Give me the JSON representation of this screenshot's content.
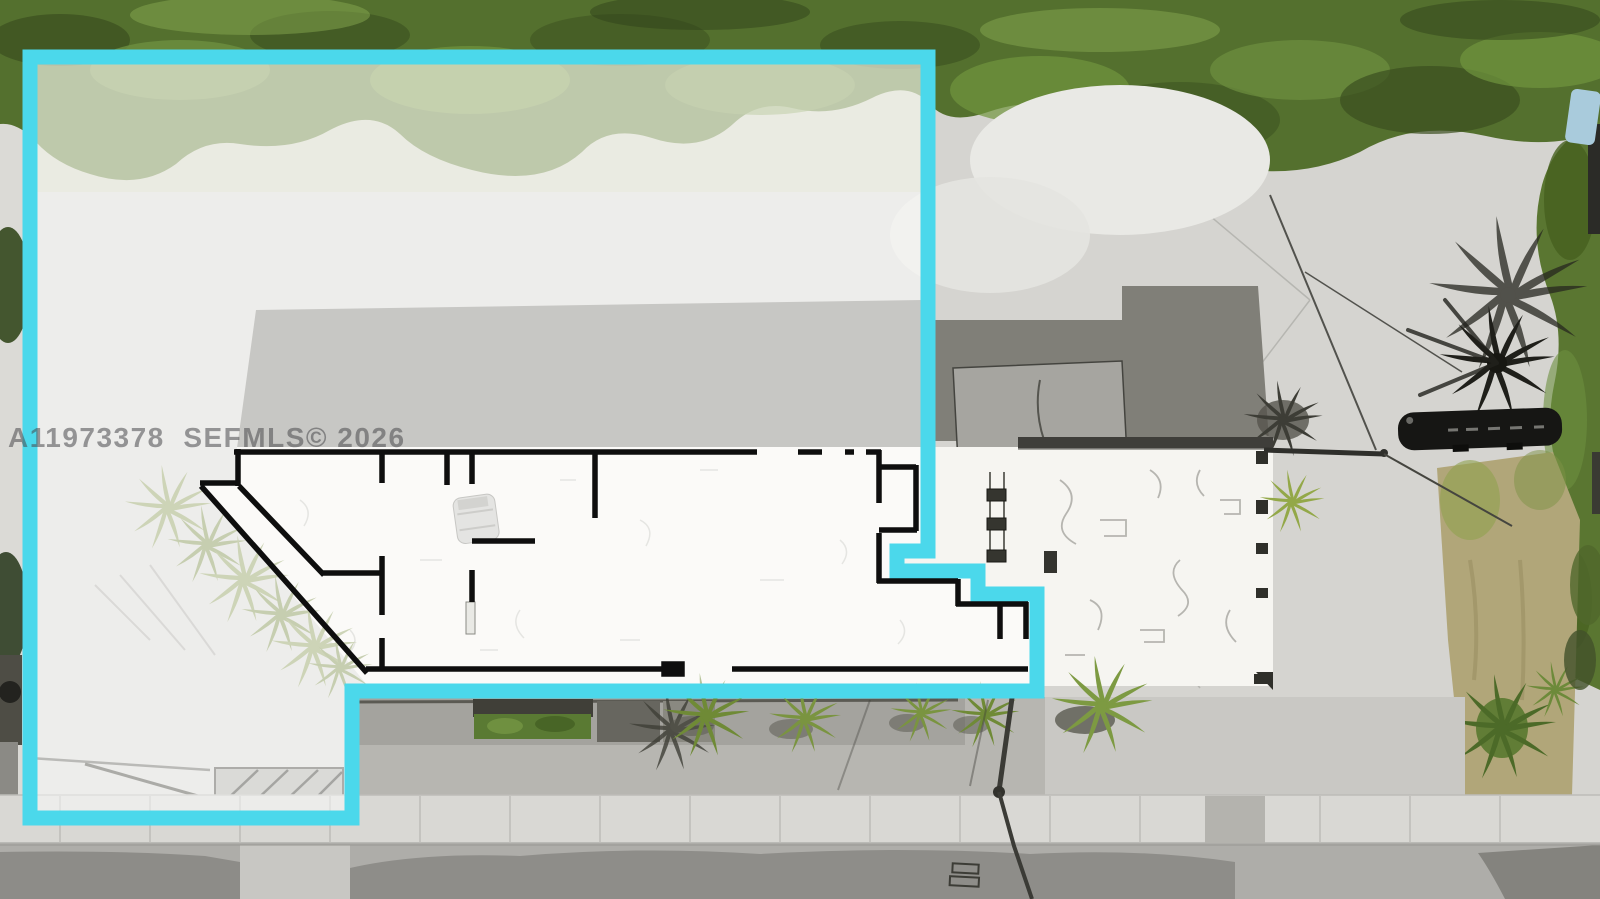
{
  "scene": {
    "description": "Aerial drone photo of a commercial lot: cyan property-boundary outline on left parcel, black floor-plan outline drawn over long white warehouse roof, trees along top, street and sidewalk at bottom"
  },
  "watermark": {
    "text": "A11973378  SEFMLS© 2026"
  },
  "overlay": {
    "boundary_color": "#4BD8EB",
    "floorplan_color": "#0E0E0E"
  }
}
